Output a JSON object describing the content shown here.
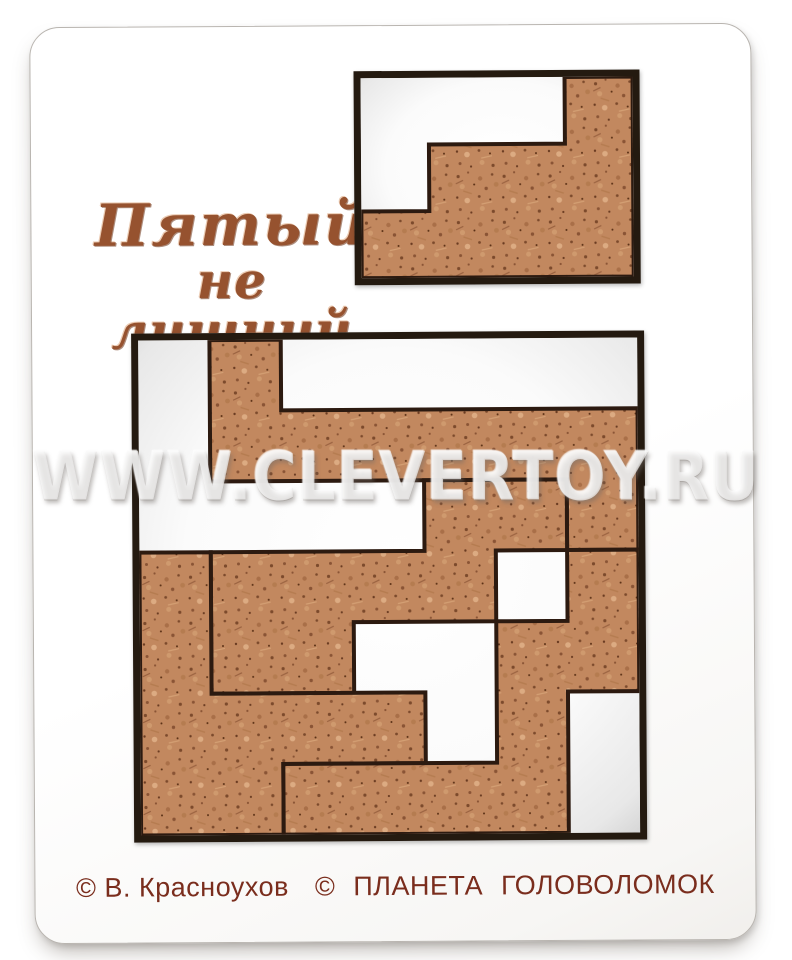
{
  "title": {
    "line1": "Пятый",
    "line2": "не лишний"
  },
  "watermark": "WWW.CLEVERTOY.RU",
  "credits": {
    "author": "© В. Красноухов",
    "publisher": "© ПЛАНЕТА ГОЛОВОЛОМОК"
  },
  "colors": {
    "wood_base": "#c2885f",
    "wood_dark": "#7c4a2c",
    "wood_darker": "#5a3015",
    "wood_light": "#dcab82",
    "wood_mid": "#a96f48",
    "tray_border": "#241a10",
    "piece_outline": "#2c1a10",
    "title_text": "#96522f",
    "credits_text": "#7a2d1d",
    "board": "#ffffff"
  },
  "puzzle": {
    "main_tray": {
      "inner_w": 499,
      "inner_h": 495,
      "cols": 7,
      "rows": 7,
      "pieces": [
        {
          "id": "piece-top-zigzag",
          "points": [
            [
              1,
              0
            ],
            [
              2,
              0
            ],
            [
              2,
              1
            ],
            [
              7,
              1
            ],
            [
              7,
              3
            ],
            [
              6,
              3
            ],
            [
              6,
              2
            ],
            [
              1,
              2
            ]
          ]
        },
        {
          "id": "piece-middle-staircase",
          "points": [
            [
              4,
              2
            ],
            [
              6,
              2
            ],
            [
              6,
              3
            ],
            [
              5,
              3
            ],
            [
              5,
              4
            ],
            [
              3,
              4
            ],
            [
              3,
              5
            ],
            [
              1,
              5
            ],
            [
              1,
              3
            ],
            [
              4,
              3
            ]
          ]
        },
        {
          "id": "piece-left-corner",
          "points": [
            [
              0,
              3
            ],
            [
              1,
              3
            ],
            [
              1,
              5
            ],
            [
              4,
              5
            ],
            [
              4,
              6
            ],
            [
              2,
              6
            ],
            [
              2,
              7
            ],
            [
              0,
              7
            ]
          ]
        },
        {
          "id": "piece-bottom-right-staircase",
          "points": [
            [
              6,
              3
            ],
            [
              7,
              3
            ],
            [
              7,
              5
            ],
            [
              6,
              5
            ],
            [
              6,
              7
            ],
            [
              2,
              7
            ],
            [
              2,
              6
            ],
            [
              5,
              6
            ],
            [
              5,
              4
            ],
            [
              6,
              4
            ]
          ]
        }
      ]
    },
    "small_tray": {
      "inner_w": 272,
      "inner_h": 200,
      "cols": 4,
      "rows": 3,
      "pieces": [
        {
          "id": "piece-fifth-staircase",
          "points": [
            [
              3,
              0
            ],
            [
              4,
              0
            ],
            [
              4,
              3
            ],
            [
              0,
              3
            ],
            [
              0,
              2
            ],
            [
              1,
              2
            ],
            [
              1,
              1
            ],
            [
              3,
              1
            ]
          ]
        }
      ]
    }
  }
}
